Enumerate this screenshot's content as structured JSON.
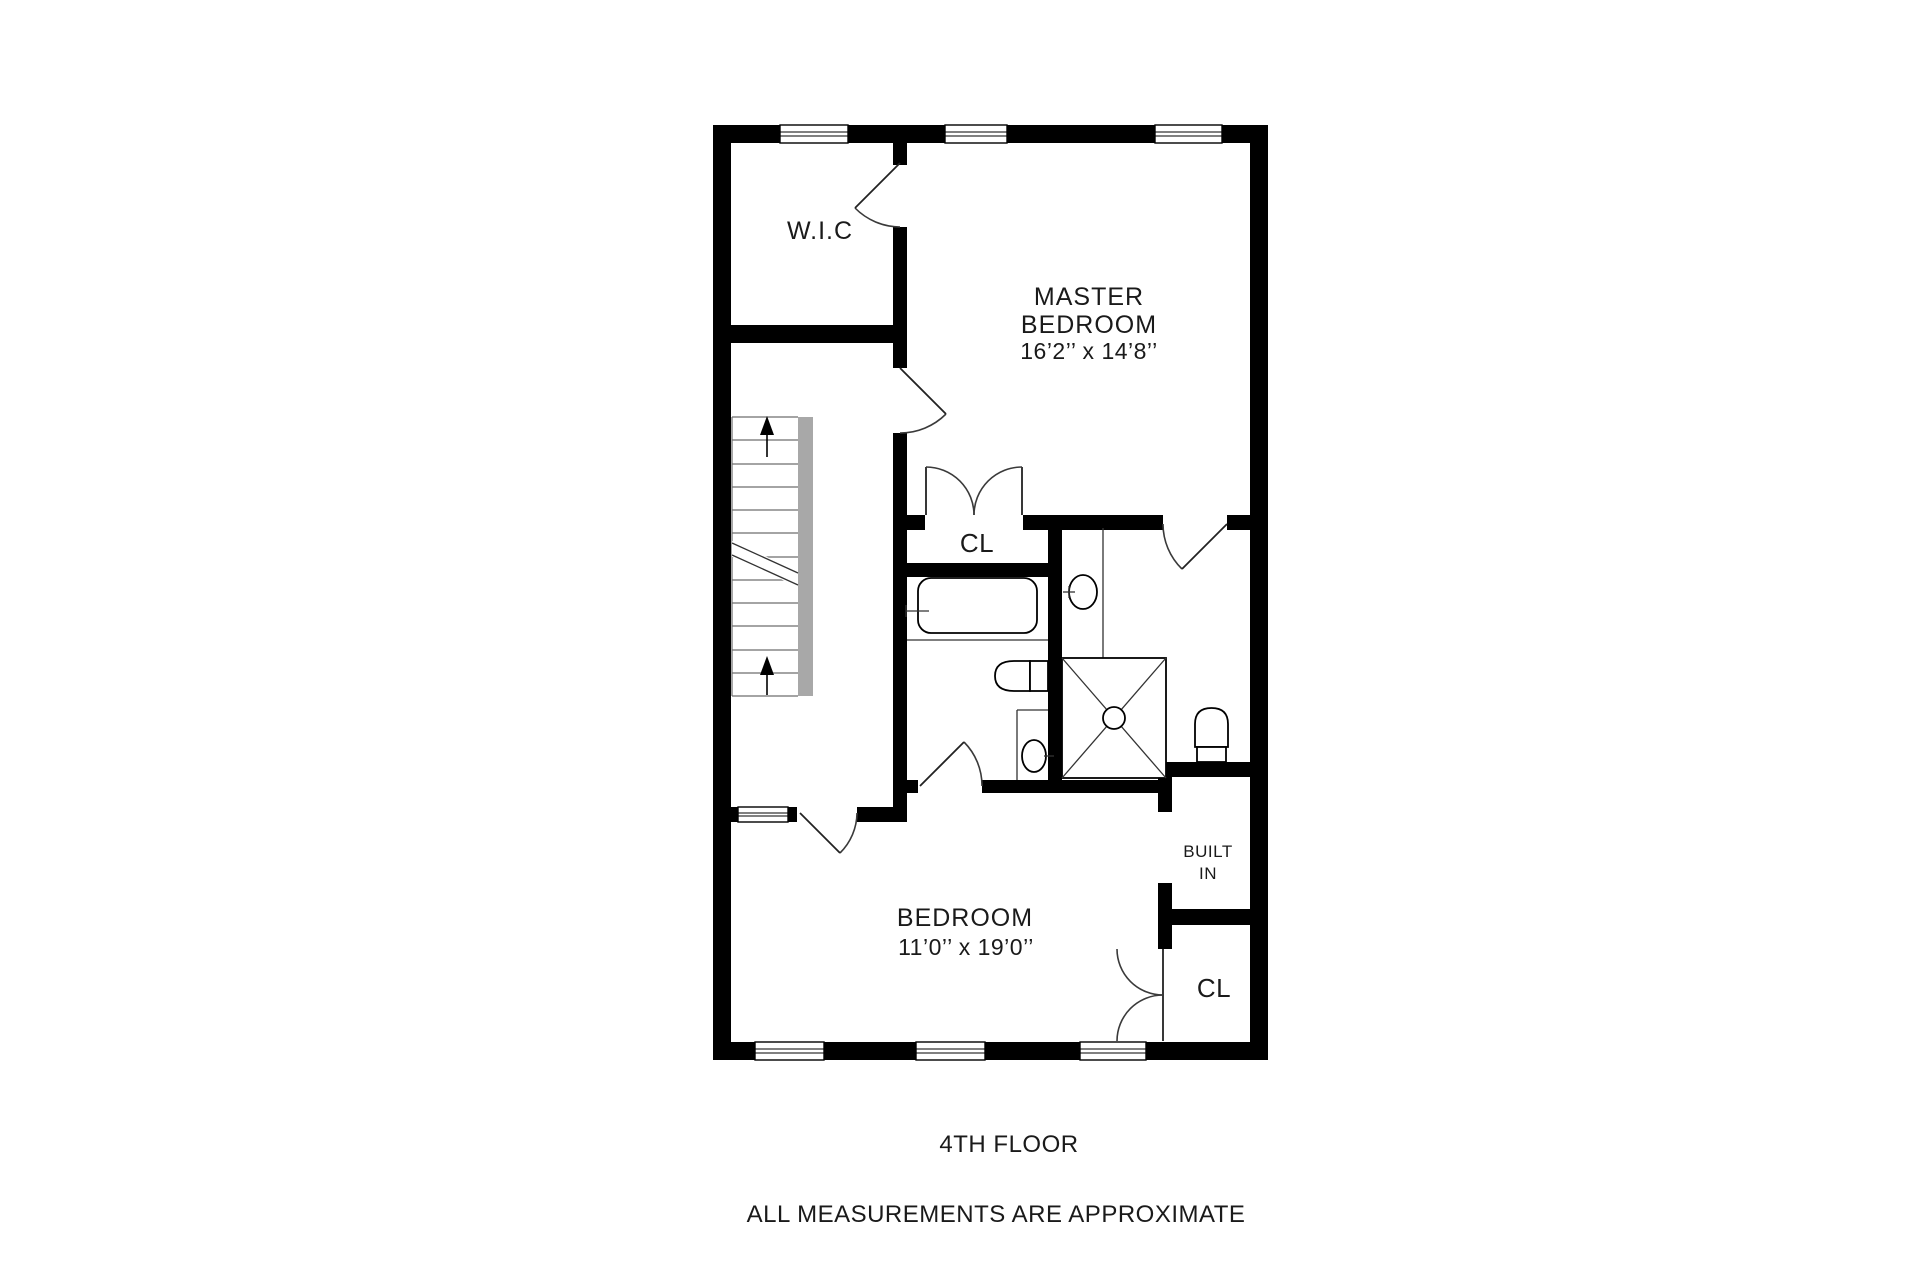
{
  "plan": {
    "labels": {
      "wic": "W.I.C",
      "master_line1": "MASTER",
      "master_line2": "BEDROOM",
      "master_dims": "16’2’’ x 14’8’’",
      "master_closet": "CL",
      "bedroom_name": "BEDROOM",
      "bedroom_dims": "11’0’’ x 19’0’’",
      "built_in_line1": "BUILT",
      "built_in_line2": "IN",
      "bedroom_closet": "CL",
      "floor_title": "4TH FLOOR",
      "disclaimer": "ALL MEASUREMENTS ARE APPROXIMATE"
    },
    "colors": {
      "wall": "#000000",
      "stair_rail": "#a8a8a8",
      "background": "#ffffff",
      "text": "#1a1a1a"
    }
  }
}
